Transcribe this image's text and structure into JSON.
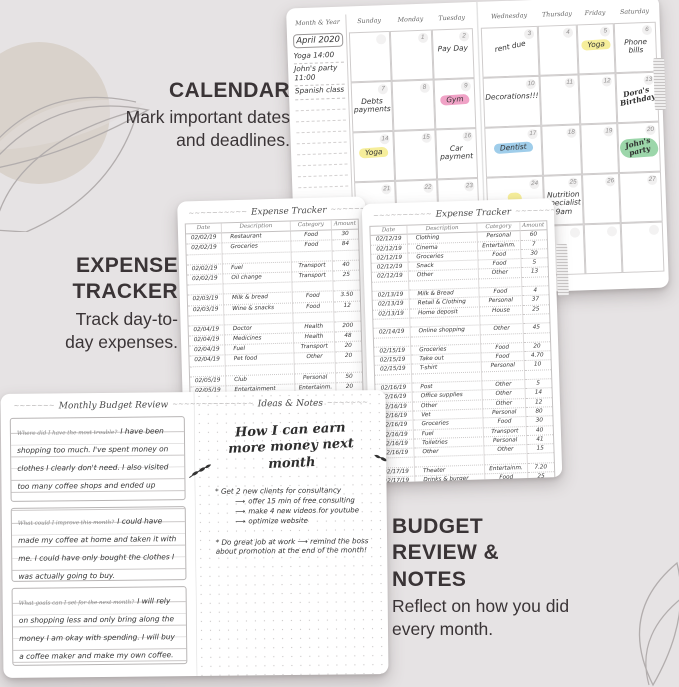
{
  "labels": {
    "calendar": {
      "title": "CALENDAR",
      "desc": "Mark important dates and deadlines."
    },
    "expense": {
      "title": "EXPENSE TRACKER",
      "desc": "Track day-to-day expenses."
    },
    "budget": {
      "title": "BUDGET REVIEW & NOTES",
      "desc": "Reflect on how you did every month."
    }
  },
  "colors": {
    "background": "#e6e3e4",
    "label_text": "#3a3436",
    "highlight_pink": "#f0a2c6",
    "highlight_yellow": "#f6ee9b",
    "highlight_blue": "#9fcdea",
    "highlight_green": "#9cd6aa"
  },
  "calendar": {
    "sidebar": {
      "header": "Month & Year",
      "month": "April 2020",
      "notes": [
        "Yoga 14:00",
        "John's party 11:00",
        "Spanish class"
      ]
    },
    "left_day_headers": [
      "Sunday",
      "Monday",
      "Tuesday"
    ],
    "right_day_headers": [
      "Wednesday",
      "Thursday",
      "Friday",
      "Saturday"
    ],
    "left_cells": [
      {
        "day": "",
        "note": "",
        "faded": true
      },
      {
        "day": "1",
        "note": ""
      },
      {
        "day": "2",
        "note": "Pay Day"
      },
      {
        "day": "7",
        "note": "Debts payments"
      },
      {
        "day": "8",
        "note": ""
      },
      {
        "day": "9",
        "note": "Gym",
        "hl": "highlight_pink"
      },
      {
        "day": "14",
        "note": "Yoga",
        "hl": "highlight_yellow"
      },
      {
        "day": "15",
        "note": ""
      },
      {
        "day": "16",
        "note": "Car payment"
      },
      {
        "day": "21",
        "note": ""
      },
      {
        "day": "22",
        "note": ""
      },
      {
        "day": "23",
        "note": ""
      }
    ],
    "right_cells": [
      {
        "day": "3",
        "note": "rent due",
        "tilt": true
      },
      {
        "day": "4",
        "note": ""
      },
      {
        "day": "5",
        "note": "Yoga",
        "hl": "highlight_yellow"
      },
      {
        "day": "6",
        "note": "Phone bills"
      },
      {
        "day": "10",
        "note": "Decorations!!!"
      },
      {
        "day": "11",
        "note": ""
      },
      {
        "day": "12",
        "note": ""
      },
      {
        "day": "13",
        "note": "Dora's Birthday",
        "script": true,
        "tilt": true
      },
      {
        "day": "17",
        "note": "Dentist",
        "hl": "highlight_blue"
      },
      {
        "day": "18",
        "note": ""
      },
      {
        "day": "19",
        "note": ""
      },
      {
        "day": "20",
        "note": "John's party",
        "hl": "highlight_green",
        "script": true,
        "tilt": true
      },
      {
        "day": "24",
        "note": "",
        "hl": "highlight_yellow"
      },
      {
        "day": "25",
        "note": "Nutrition specialist 9am"
      },
      {
        "day": "26",
        "note": ""
      },
      {
        "day": "27",
        "note": ""
      }
    ]
  },
  "expense_left": {
    "title": "Expense Tracker",
    "headers": [
      "Date",
      "Description",
      "Category",
      "Amount"
    ],
    "rows": [
      [
        "02/02/19",
        "Restaurant",
        "Food",
        "30"
      ],
      [
        "02/02/19",
        "Groceries",
        "Food",
        "84"
      ],
      [
        "",
        "",
        "",
        ""
      ],
      [
        "02/02/19",
        "Fuel",
        "Transport",
        "40"
      ],
      [
        "02/02/19",
        "Oil change",
        "Transport",
        "25"
      ],
      [
        "",
        "",
        "",
        ""
      ],
      [
        "02/03/19",
        "Milk & bread",
        "Food",
        "3.50"
      ],
      [
        "02/03/19",
        "Wine & snacks",
        "Food",
        "12"
      ],
      [
        "",
        "",
        "",
        ""
      ],
      [
        "02/04/19",
        "Doctor",
        "Health",
        "200"
      ],
      [
        "02/04/19",
        "Medicines",
        "Health",
        "48"
      ],
      [
        "02/04/19",
        "Fuel",
        "Transport",
        "20"
      ],
      [
        "02/04/19",
        "Pet food",
        "Other",
        "20"
      ],
      [
        "",
        "",
        "",
        ""
      ],
      [
        "02/05/19",
        "Club",
        "Personal",
        "50"
      ],
      [
        "02/05/19",
        "Entertainment",
        "Entertainm.",
        "20"
      ],
      [
        "02/06/19",
        "Steak house",
        "Food",
        "15"
      ],
      [
        "02/06/19",
        "Wine",
        "Food",
        "7"
      ],
      [
        "",
        "",
        "",
        ""
      ],
      [
        "",
        "",
        "",
        ""
      ]
    ]
  },
  "expense_right": {
    "title": "Expense Tracker",
    "headers": [
      "Date",
      "Description",
      "Category",
      "Amount"
    ],
    "rows": [
      [
        "02/12/19",
        "Clothing",
        "Personal",
        "60"
      ],
      [
        "02/12/19",
        "Cinema",
        "Entertainm.",
        "7"
      ],
      [
        "02/12/19",
        "Groceries",
        "Food",
        "30"
      ],
      [
        "02/12/19",
        "Snack",
        "Food",
        "5"
      ],
      [
        "02/12/19",
        "Other",
        "Other",
        "13"
      ],
      [
        "",
        "",
        "",
        ""
      ],
      [
        "02/13/19",
        "Milk & Bread",
        "Food",
        "4"
      ],
      [
        "02/13/19",
        "Retail & Clothing",
        "Personal",
        "37"
      ],
      [
        "02/13/19",
        "Home deposit",
        "House",
        "25"
      ],
      [
        "",
        "",
        "",
        ""
      ],
      [
        "02/14/19",
        "Online shopping",
        "Other",
        "45"
      ],
      [
        "",
        "",
        "",
        ""
      ],
      [
        "02/15/19",
        "Groceries",
        "Food",
        "20"
      ],
      [
        "02/15/19",
        "Take out",
        "Food",
        "4.70"
      ],
      [
        "02/15/19",
        "T-shirt",
        "Personal",
        "10"
      ],
      [
        "",
        "",
        "",
        ""
      ],
      [
        "02/16/19",
        "Post",
        "Other",
        "5"
      ],
      [
        "02/16/19",
        "Office supplies",
        "Other",
        "14"
      ],
      [
        "02/16/19",
        "Other",
        "Other",
        "12"
      ],
      [
        "02/16/19",
        "Vet",
        "Personal",
        "80"
      ],
      [
        "02/16/19",
        "Groceries",
        "Food",
        "30"
      ],
      [
        "02/16/19",
        "Fuel",
        "Transport",
        "40"
      ],
      [
        "02/16/19",
        "Toiletries",
        "Personal",
        "41"
      ],
      [
        "02/16/19",
        "Other",
        "Other",
        "15"
      ],
      [
        "",
        "",
        "",
        ""
      ],
      [
        "02/17/19",
        "Theater",
        "Entertainm.",
        "7.20"
      ],
      [
        "02/17/19",
        "Drinks & burger",
        "Food",
        "25"
      ],
      [
        "02/17/19",
        "Cleaning",
        "House",
        "85"
      ]
    ]
  },
  "budget_review": {
    "title": "Monthly Budget Review",
    "sections": [
      {
        "prompt": "Where did I have the most trouble?",
        "answer": "I have been shopping too much. I've spent money on clothes I clearly don't need. I also visited too many coffee shops and ended up spending a fortune on coffee."
      },
      {
        "prompt": "What could I improve this month?",
        "answer": "I could have made my coffee at home and taken it with me. I could have only bought the clothes I was actually going to buy."
      },
      {
        "prompt": "What goals can I set for the next month?",
        "answer": "I will rely on shopping less and only bring along the money I am okay with spending. I will buy a coffee maker and make my own coffee."
      }
    ]
  },
  "ideas_notes": {
    "title": "Ideas & Notes",
    "heading": "How I can earn more money next month",
    "bullet1": "* Get 2 new clients for consultancy",
    "arrows": [
      "offer 15 min of free consulting",
      "make 4 new videos for youtube",
      "optimize website"
    ],
    "bullet2": "* Do great job at work ⟶ remind the boss about promotion at the end of the month!"
  }
}
